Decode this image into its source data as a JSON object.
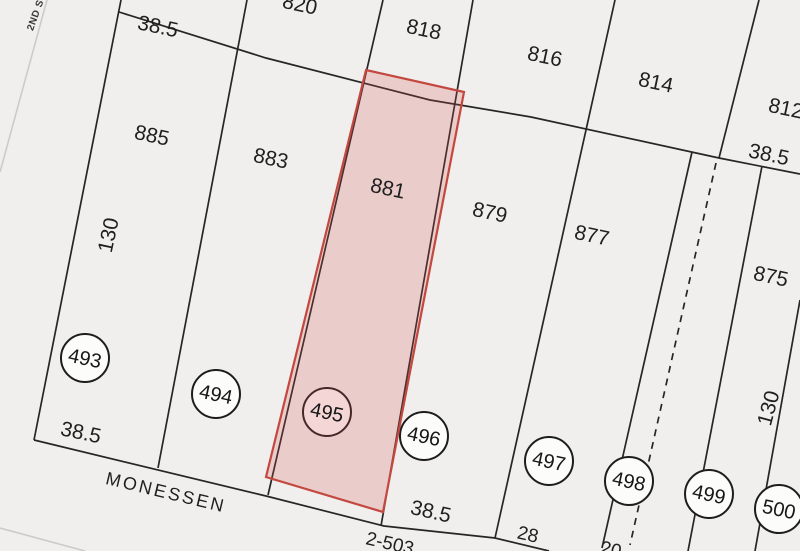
{
  "map_type": "cadastral plat map",
  "colors": {
    "background": "#f0efed",
    "parcel_line": "#262626",
    "street_line": "#cbcbca",
    "highlight_fill": "rgba(213,84,76,0.22)",
    "highlight_stroke": "#c3483f",
    "lot_circle_fill": "#fcfcfb"
  },
  "streets": {
    "left_street": "2ND S",
    "bottom_street": "MONESSEN"
  },
  "top_row_parcels": [
    "820",
    "818",
    "816",
    "814",
    "812"
  ],
  "main_row_parcels": [
    "885",
    "883",
    "881",
    "879",
    "877",
    "875"
  ],
  "lot_numbers": [
    "493",
    "494",
    "495",
    "496",
    "497",
    "498",
    "499",
    "500"
  ],
  "dimensions": {
    "top_left_width": "38.5",
    "right_width": "38.5",
    "left_depth": "130",
    "right_depth": "130",
    "bottom_left_width": "38.5",
    "bottom_middle_width": "38.5",
    "bottom_width_28": "28",
    "bottom_width_20": "20"
  },
  "plat_book_reference": "2-503",
  "highlighted_parcel": {
    "parcel": "881",
    "lot_number": "495"
  }
}
